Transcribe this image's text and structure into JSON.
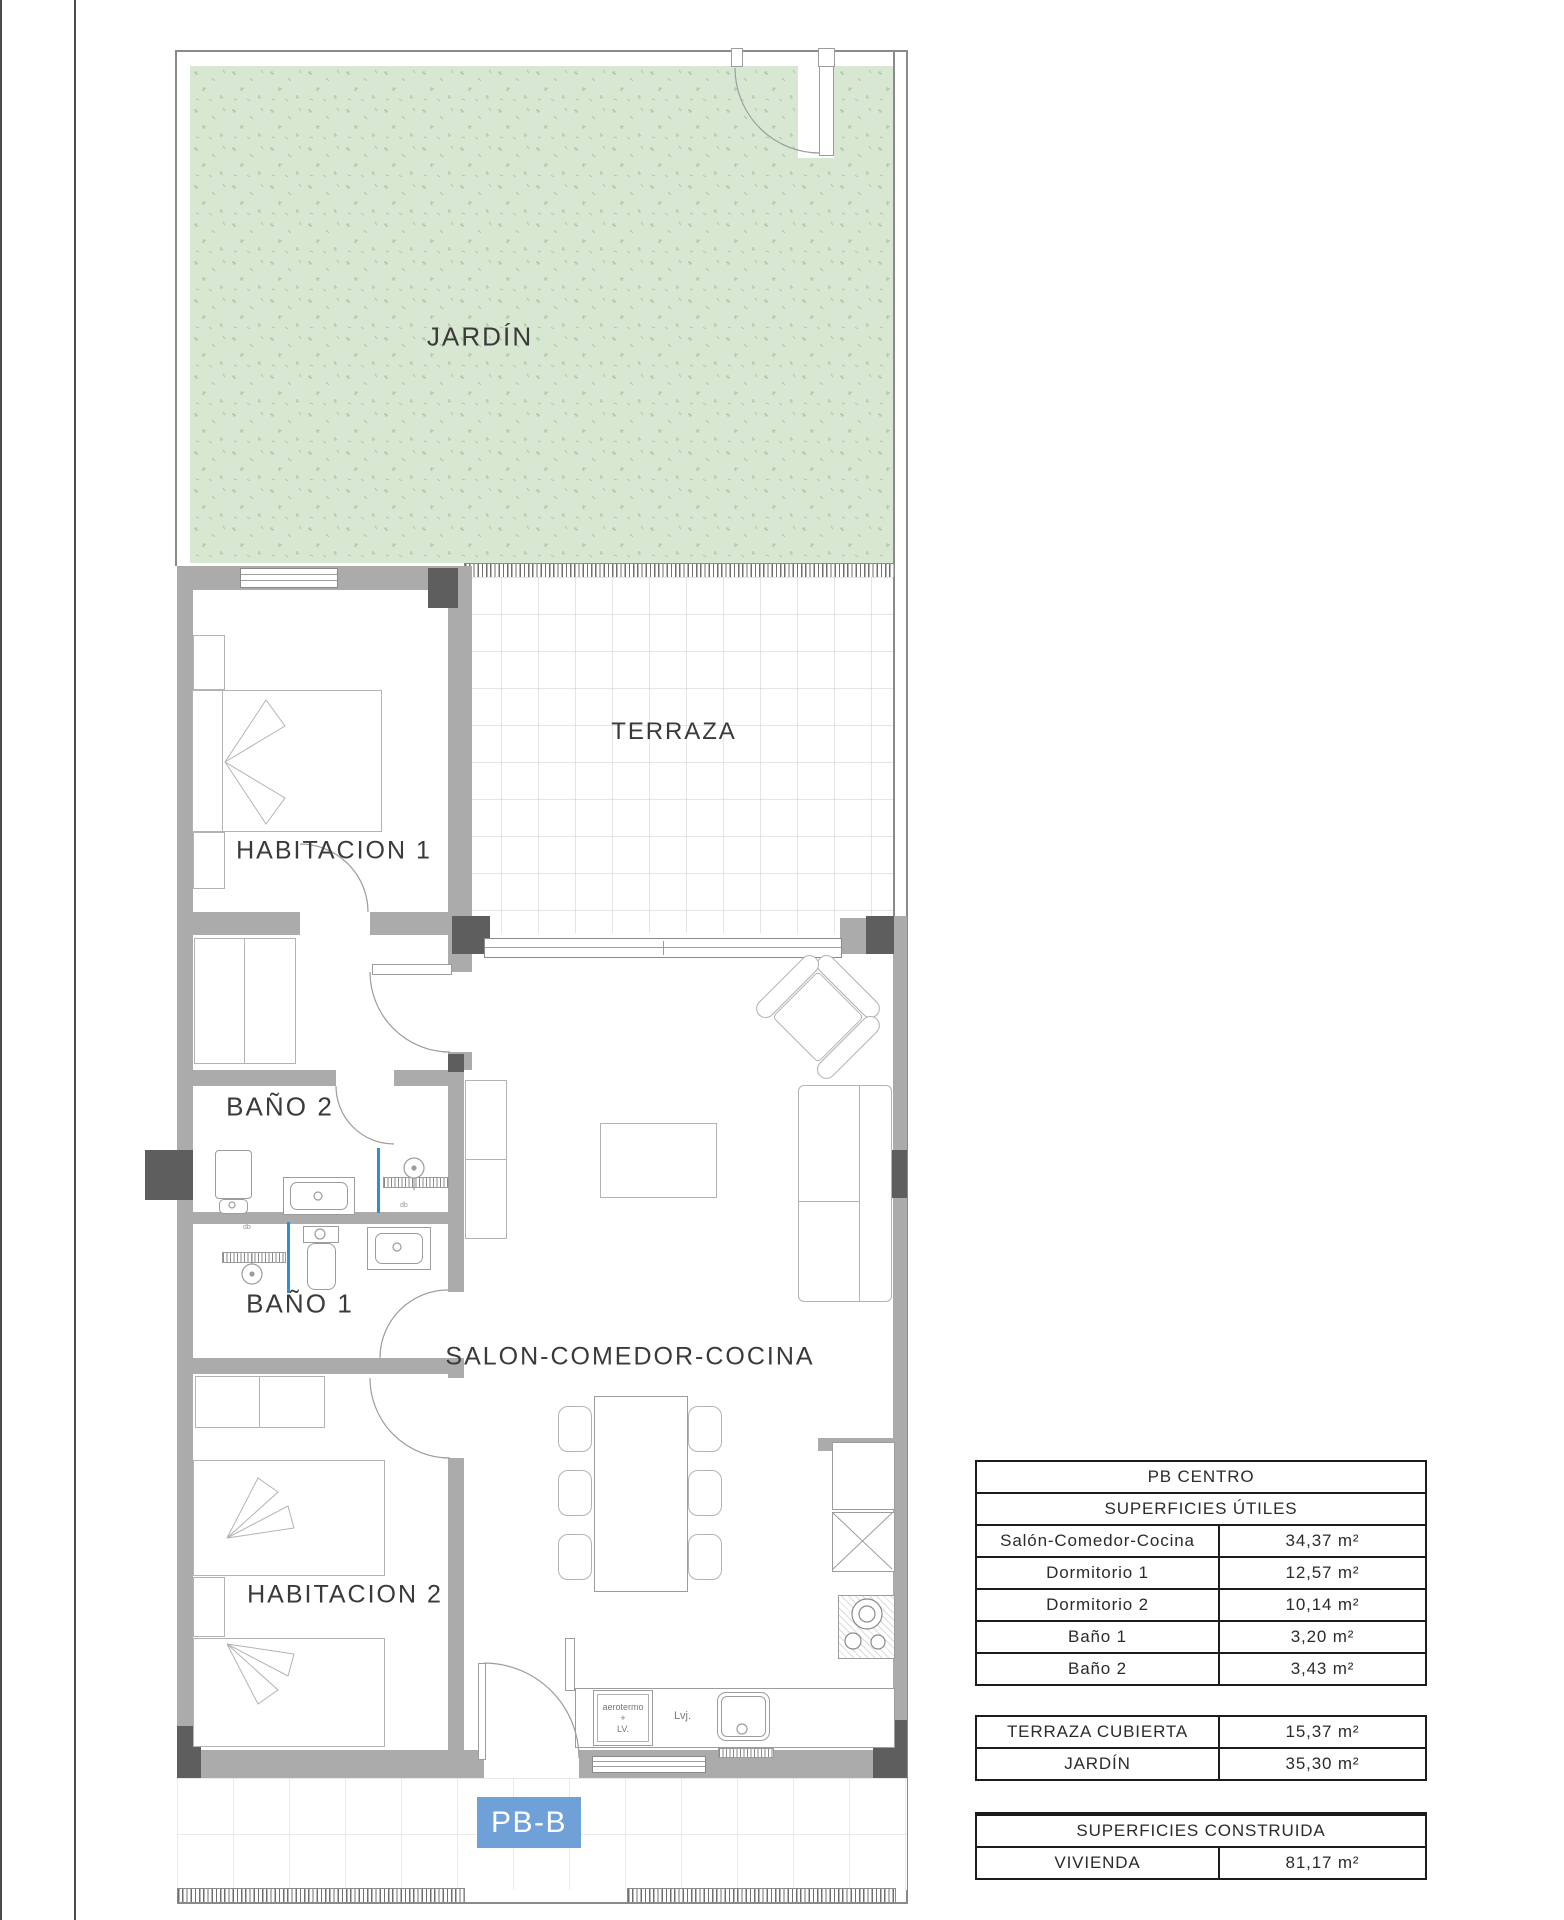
{
  "plan": {
    "rooms": {
      "jardin": "JARDÍN",
      "terraza": "TERRAZA",
      "habitacion1": "HABITACION 1",
      "bano2": "BAÑO 2",
      "bano1": "BAÑO 1",
      "habitacion2": "HABITACION 2",
      "salon": "SALON-COMEDOR-COCINA"
    },
    "unit_label": "PB-B",
    "kitchen": {
      "aerotermo": "aerotermo",
      "plus": "+",
      "lv": "LV.",
      "lvj": "Lvj."
    },
    "fixture_code": "db"
  },
  "tables": {
    "utiles": {
      "title": "PB CENTRO",
      "subtitle": "SUPERFICIES ÚTILES",
      "rows": [
        {
          "label": "Salón-Comedor-Cocina",
          "value": "34,37 m²"
        },
        {
          "label": "Dormitorio 1",
          "value": "12,57 m²"
        },
        {
          "label": "Dormitorio 2",
          "value": "10,14 m²"
        },
        {
          "label": "Baño 1",
          "value": "3,20 m²"
        },
        {
          "label": "Baño 2",
          "value": "3,43 m²"
        }
      ]
    },
    "exterior": {
      "rows": [
        {
          "label": "TERRAZA CUBIERTA",
          "value": "15,37 m²"
        },
        {
          "label": "JARDÍN",
          "value": "35,30 m²"
        }
      ]
    },
    "construida": {
      "title": "SUPERFICIES CONSTRUIDA",
      "rows": [
        {
          "label": "VIVIENDA",
          "value": "81,17 m²"
        }
      ]
    }
  },
  "colors": {
    "garden_green": "#d8e7d2",
    "wall_gray": "#ababab",
    "pillar_gray": "#5e5e5e",
    "screen_blue": "#2f8fd0",
    "unit_label_blue": "#6fa0d8"
  }
}
